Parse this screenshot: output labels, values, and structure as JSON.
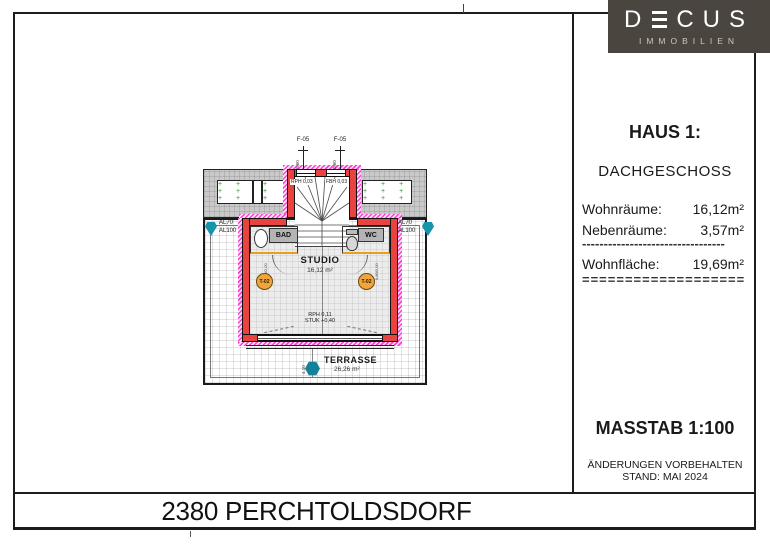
{
  "logo": {
    "brand_prefix": "D",
    "brand_suffix": "CUS",
    "e_icon": "triple-bar-E",
    "sub": "IMMOBILIEN"
  },
  "info_panel": {
    "title": "HAUS 1:",
    "subtitle": "DACHGESCHOSS",
    "rows": [
      {
        "label": "Wohnräume:",
        "value": "16,12m²"
      },
      {
        "label": "Nebenräume:",
        "value": "3,57m²"
      }
    ],
    "divider_dashed": "---------------------------------",
    "total": {
      "label": "Wohnfläche:",
      "value": "19,69m²"
    },
    "divider_double": "====================",
    "scale": "MASSTAB 1:100",
    "note1": "ÄNDERUNGEN VORBEHALTEN",
    "note2": "STAND: MAI 2024"
  },
  "title_bar": {
    "text": "2380 PERCHTOLDSDORF"
  },
  "plan": {
    "window_tag_1": "F-05",
    "window_tag_2": "F-05",
    "window_dim_1": "0,60",
    "window_dim_2": "0,60",
    "level_note_left": "RPH 0,03",
    "level_note_right": "FBH 0,03",
    "room_bad": "BAD",
    "room_wc": "WC",
    "room_studio": "STUDIO",
    "studio_area": "16,12 m²",
    "room_terrasse": "TERRASSE",
    "terrasse_area": "26,26 m²",
    "floor_note_1": "RPH 0,11",
    "floor_note_2": "STUK +0,40",
    "door_marker_left": "T-02",
    "door_marker_right": "T-02",
    "al_left_1": "AL70",
    "al_left_2": "AL100",
    "al_right_1": "AL70",
    "al_right_2": "AL100",
    "door_size_left": "0,80/2,00",
    "door_size_right": "0,80/2,00",
    "dim_v1": "4,10",
    "dim_v2": "2,50"
  },
  "colors": {
    "wall_red": "#e8433e",
    "insulation_magenta": "#ff3fd0",
    "marker_teal": "#1793ab",
    "marker_orange": "#f2a53a",
    "roof_gray": "#c9c9c9",
    "logo_bg": "#4b453f",
    "green_plus": "#2f8f2f"
  }
}
